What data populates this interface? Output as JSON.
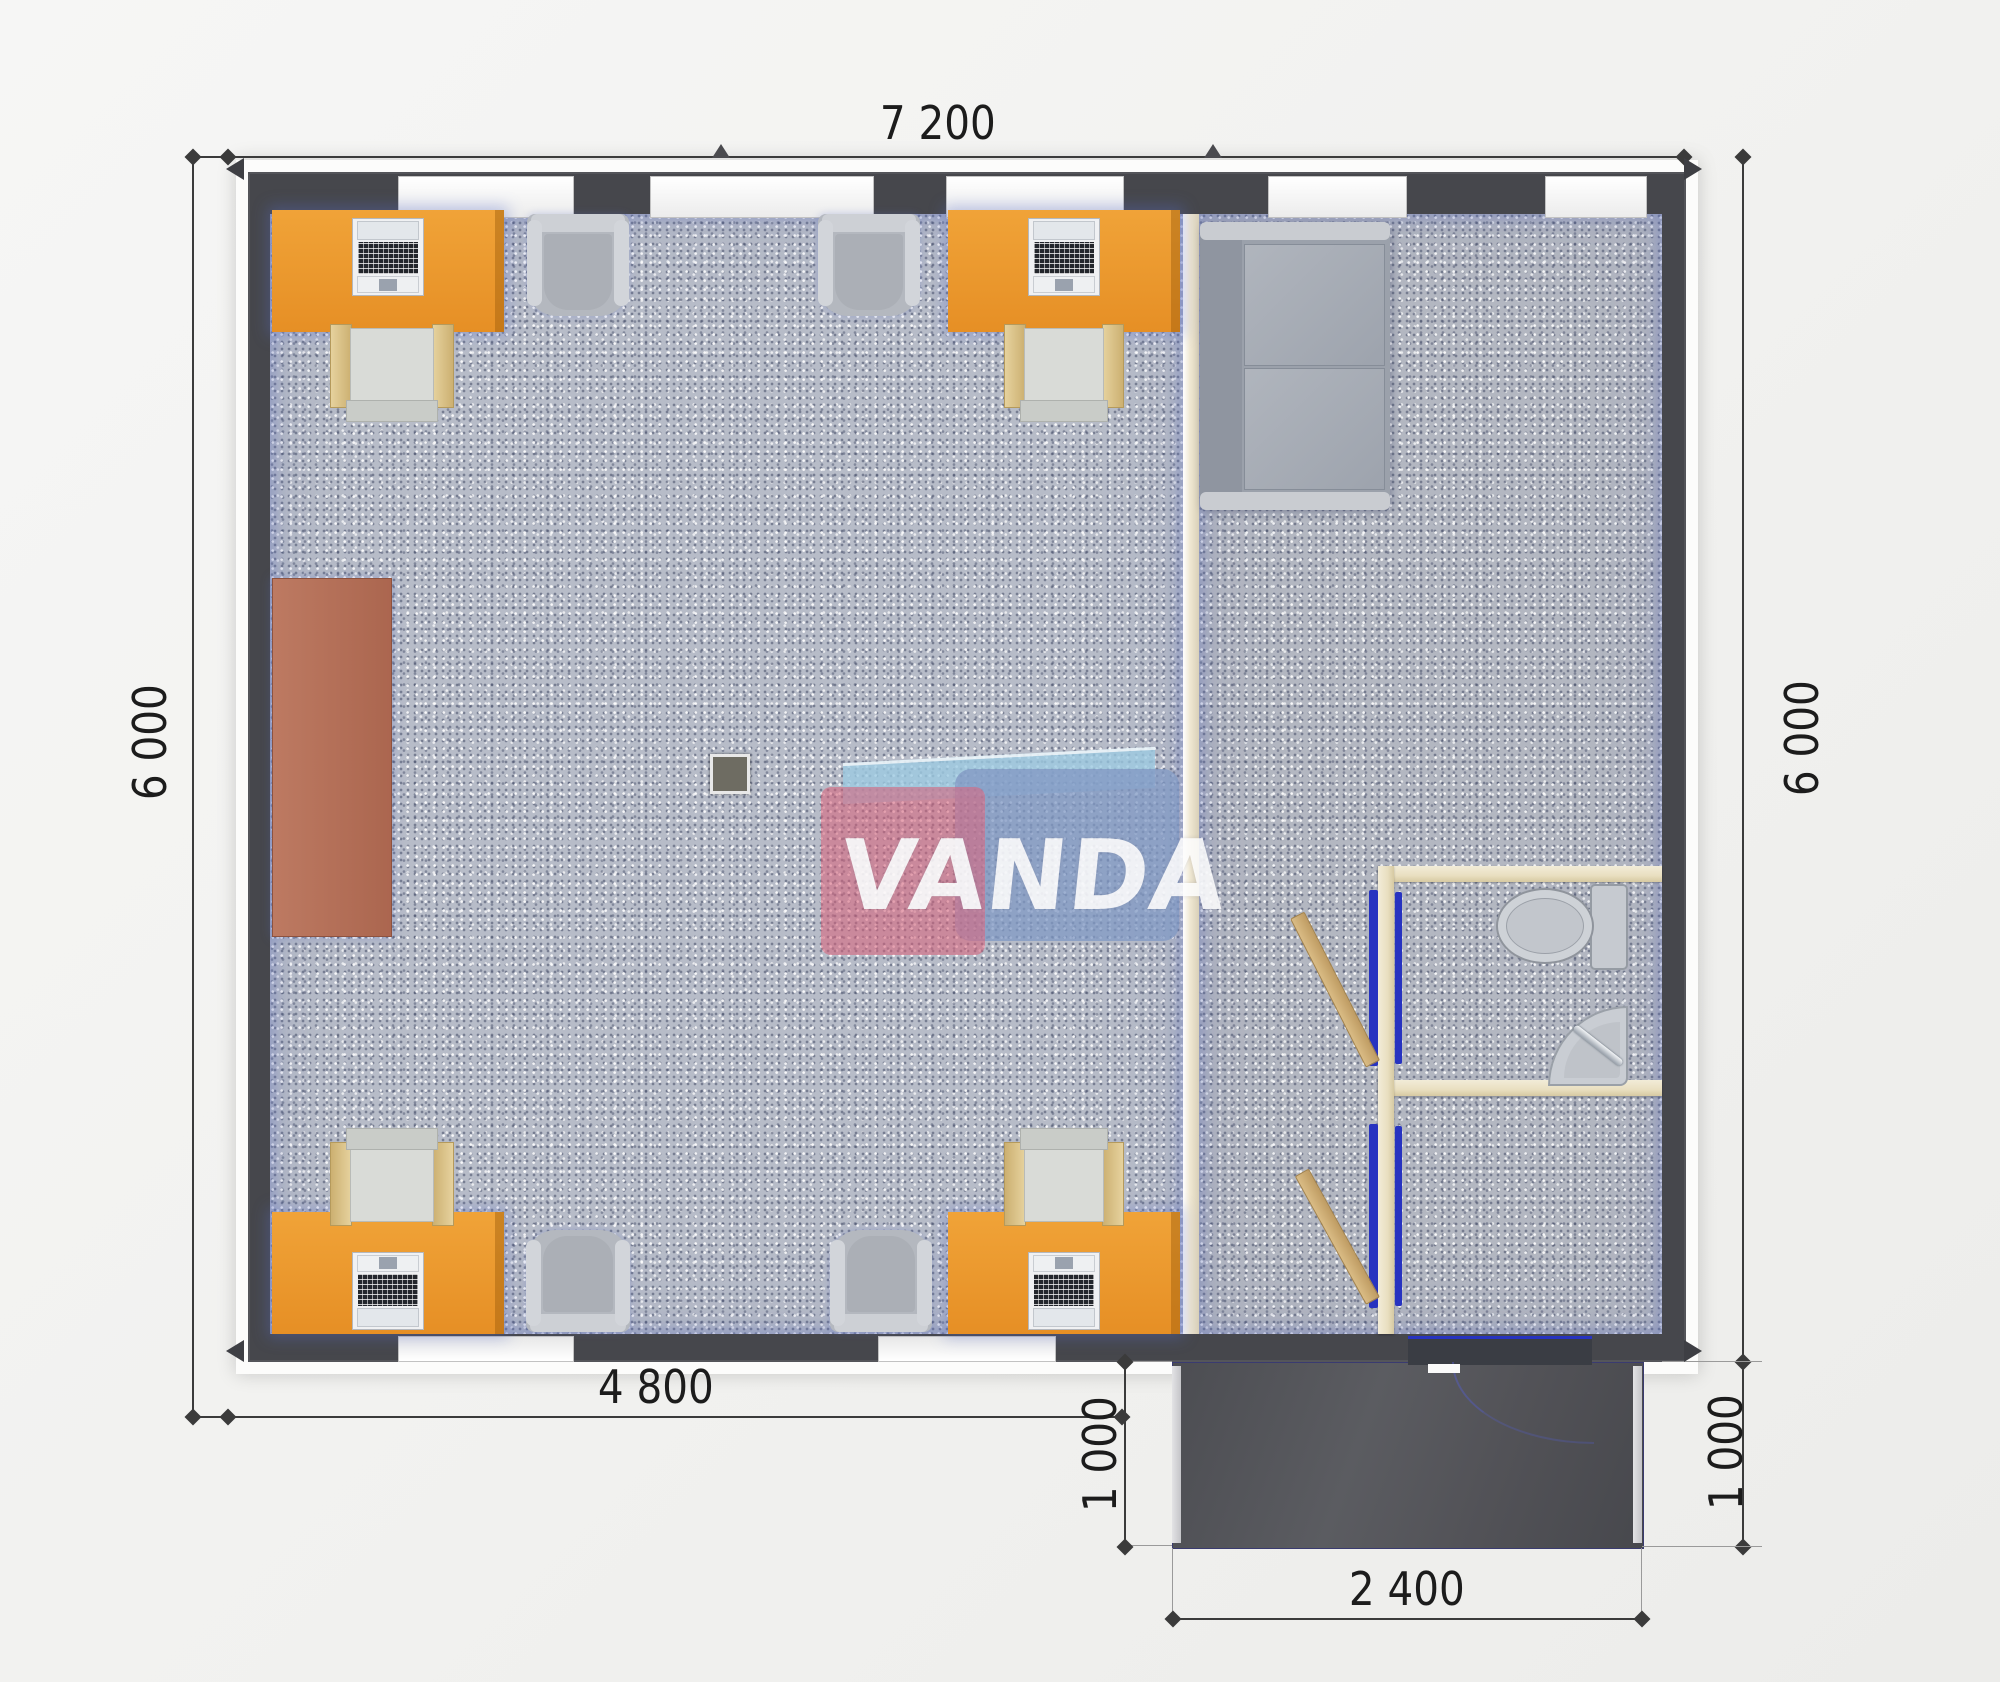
{
  "watermark": {
    "part1": "VAN",
    "part2": "DA"
  },
  "dimensions": {
    "top_width": "7 200",
    "left_height": "6 000",
    "right_height": "6 000",
    "bottom_width": "4 800",
    "porch_height_left": "1 000",
    "porch_height_right": "1 000",
    "porch_width": "2 400"
  },
  "colors": {
    "desk_orange": "#EA962E",
    "cabinet_brown": "#B5705A",
    "wall_dark": "#46474C",
    "floor_blue_gray": "#B7BCC8",
    "porch_dark": "#55565B",
    "partition_cream": "#EFE7D2",
    "wc_wall_cream": "#E9DFC0",
    "door_frame_blue": "#2733C0",
    "door_wood": "#CDAB72",
    "logo_pink": "#D8627A",
    "logo_blue": "#8299C4",
    "logo_ribbon": "#9CCAE2"
  },
  "furniture": {
    "desks_with_computers": 4,
    "office_chairs": 4,
    "armchairs": 4,
    "sofa": 1,
    "storage_cabinet": 1,
    "toilet": 1,
    "corner_sink": 1,
    "open_doors": 2,
    "floor_box": 1
  }
}
